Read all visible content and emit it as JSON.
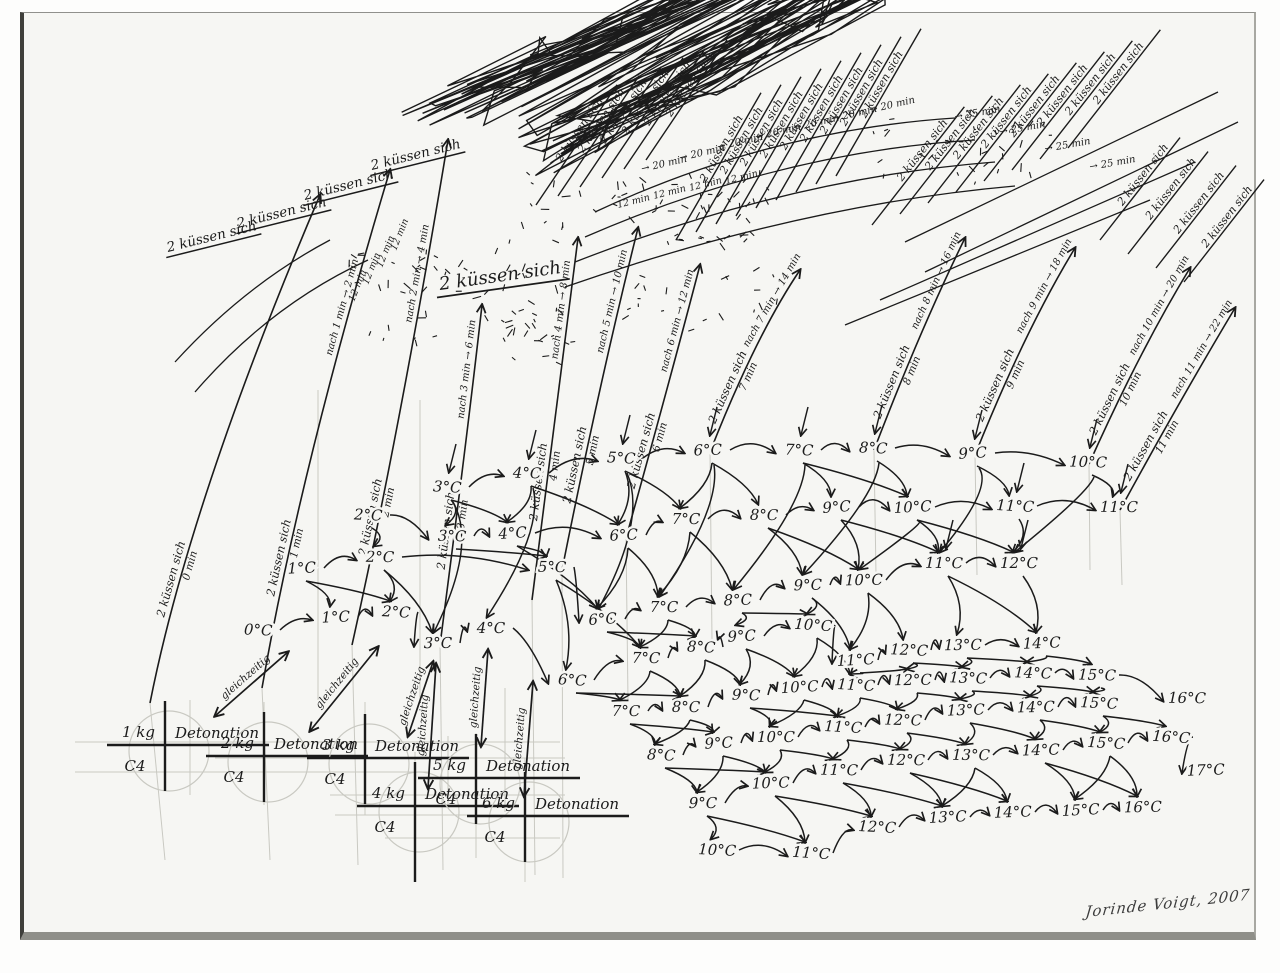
{
  "canvas": {
    "w": 1280,
    "h": 973,
    "paper": "#f6f6f3",
    "ink": "#1b1b1b",
    "pencil": "#c9c9c2",
    "signature": "Jorinde Voigt, 2007"
  },
  "labels": {
    "kiss": "2 küssen sich",
    "simultaneous": "gleichzeitig",
    "detonation_word": "Detonation",
    "c4_word": "C4"
  },
  "detonations": [
    {
      "kg": "1 kg",
      "x": 165,
      "y": 745
    },
    {
      "kg": "2 kg",
      "x": 264,
      "y": 756
    },
    {
      "kg": "3 kg",
      "x": 365,
      "y": 758
    },
    {
      "kg": "4 kg",
      "x": 415,
      "y": 806
    },
    {
      "kg": "5 kg",
      "x": 476,
      "y": 778
    },
    {
      "kg": "6 kg",
      "x": 525,
      "y": 816
    }
  ],
  "bands": [
    [
      [
        "3°C",
        447,
        492
      ],
      [
        "4°C",
        527,
        478
      ],
      [
        "5°C",
        621,
        463
      ],
      [
        "6°C",
        708,
        455
      ],
      [
        "7°C",
        799,
        455
      ],
      [
        "8°C",
        873,
        453
      ],
      [
        "9°C",
        973,
        458
      ],
      [
        "10°C",
        1088,
        467
      ]
    ],
    [
      [
        "2°C",
        368,
        520
      ],
      [
        "3°C",
        452,
        541
      ],
      [
        "4°C",
        513,
        538
      ],
      [
        "6°C",
        624,
        540
      ],
      [
        "7°C",
        686,
        524
      ],
      [
        "8°C",
        764,
        520
      ],
      [
        "9°C",
        837,
        512
      ],
      [
        "10°C",
        913,
        512
      ],
      [
        "11°C",
        1015,
        511
      ],
      [
        "11°C",
        1119,
        512
      ]
    ],
    [
      [
        "1°C",
        302,
        573
      ],
      [
        "2°C",
        380,
        562
      ],
      [
        "5°C",
        552,
        572
      ],
      [
        "6°C",
        603,
        624
      ],
      [
        "7°C",
        664,
        612
      ],
      [
        "8°C",
        738,
        605
      ],
      [
        "9°C",
        808,
        590
      ],
      [
        "10°C",
        864,
        585
      ],
      [
        "11°C",
        944,
        568
      ],
      [
        "12°C",
        1019,
        568
      ]
    ],
    [
      [
        "0°C",
        258,
        635
      ],
      [
        "1°C",
        336,
        622
      ],
      [
        "2°C",
        396,
        617
      ],
      [
        "3°C",
        438,
        648
      ],
      [
        "4°C",
        491,
        633
      ],
      [
        "6°C",
        572,
        685
      ],
      [
        "7°C",
        646,
        663
      ],
      [
        "8°C",
        701,
        652
      ],
      [
        "9°C",
        742,
        641
      ],
      [
        "10°C",
        813,
        630
      ],
      [
        "11°C",
        856,
        665
      ],
      [
        "12°C",
        909,
        655
      ],
      [
        "13°C",
        963,
        650
      ],
      [
        "14°C",
        1042,
        648
      ]
    ],
    [
      [
        "7°C",
        626,
        716
      ],
      [
        "8°C",
        686,
        712
      ],
      [
        "9°C",
        746,
        700
      ],
      [
        "10°C",
        800,
        692
      ],
      [
        "11°C",
        856,
        690
      ],
      [
        "12°C",
        913,
        685
      ],
      [
        "13°C",
        968,
        683
      ],
      [
        "14°C",
        1033,
        678
      ],
      [
        "15°C",
        1097,
        680
      ],
      [
        "16°C",
        1187,
        703
      ]
    ],
    [
      [
        "8°C",
        661,
        760
      ],
      [
        "9°C",
        719,
        748
      ],
      [
        "10°C",
        776,
        742
      ],
      [
        "11°C",
        843,
        732
      ],
      [
        "12°C",
        903,
        725
      ],
      [
        "13°C",
        966,
        715
      ],
      [
        "14°C",
        1036,
        712
      ],
      [
        "15°C",
        1099,
        708
      ]
    ],
    [
      [
        "9°C",
        703,
        808
      ],
      [
        "10°C",
        771,
        788
      ],
      [
        "11°C",
        839,
        775
      ],
      [
        "12°C",
        906,
        765
      ],
      [
        "13°C",
        971,
        760
      ],
      [
        "14°C",
        1041,
        755
      ],
      [
        "15°C",
        1106,
        748
      ],
      [
        "16°C",
        1171,
        742
      ],
      [
        "17°C",
        1206,
        775
      ]
    ],
    [
      [
        "10°C",
        717,
        855
      ],
      [
        "11°C",
        811,
        858
      ],
      [
        "12°C",
        877,
        832
      ],
      [
        "13°C",
        948,
        822
      ],
      [
        "14°C",
        1013,
        817
      ],
      [
        "15°C",
        1081,
        815
      ],
      [
        "16°C",
        1143,
        812
      ]
    ]
  ],
  "kiss_arcs": [
    {
      "min": "0 min",
      "note": "",
      "bx": 150,
      "by": 703,
      "cx": 190,
      "cy": 500,
      "ex": 320,
      "ey": 195
    },
    {
      "min": "1 min",
      "note": "nach 1 min → 2 min",
      "bx": 262,
      "by": 688,
      "cx": 300,
      "cy": 470,
      "ex": 390,
      "ey": 170
    },
    {
      "min": "2 min",
      "note": "nach 2 min → 4 min",
      "bx": 352,
      "by": 645,
      "cx": 400,
      "cy": 430,
      "ex": 448,
      "ey": 140
    },
    {
      "min": "3 min",
      "note": "nach 3 min → 6 min",
      "bx": 440,
      "by": 645,
      "cx": 468,
      "cy": 430,
      "ex": 482,
      "ey": 305
    },
    {
      "min": "4 min",
      "note": "nach 4 min → 8 min",
      "bx": 532,
      "by": 600,
      "cx": 560,
      "cy": 380,
      "ex": 578,
      "ey": 238
    },
    {
      "min": "5 min",
      "note": "nach 5 min → 10 min",
      "bx": 562,
      "by": 570,
      "cx": 600,
      "cy": 380,
      "ex": 638,
      "ey": 228
    },
    {
      "min": "6 min",
      "note": "nach 6 min → 12 min",
      "bx": 626,
      "by": 538,
      "cx": 670,
      "cy": 380,
      "ex": 700,
      "ey": 265
    },
    {
      "min": "7 min",
      "note": "nach 7 min → 14 min",
      "bx": 710,
      "by": 452,
      "cx": 756,
      "cy": 335,
      "ex": 800,
      "ey": 270
    },
    {
      "min": "8 min",
      "note": "nach 8 min → 16 min",
      "bx": 874,
      "by": 450,
      "cx": 920,
      "cy": 330,
      "ex": 965,
      "ey": 238
    },
    {
      "min": "9 min",
      "note": "nach 9 min → 18 min",
      "bx": 975,
      "by": 455,
      "cx": 1025,
      "cy": 330,
      "ex": 1075,
      "ey": 248
    },
    {
      "min": "10 min",
      "note": "nach 10 min → 20 min",
      "bx": 1089,
      "by": 464,
      "cx": 1140,
      "cy": 350,
      "ex": 1190,
      "ey": 268
    },
    {
      "min": "11 min",
      "note": "nach 11 min → 22 min",
      "bx": 1120,
      "by": 510,
      "cx": 1180,
      "cy": 400,
      "ex": 1235,
      "ey": 308
    }
  ],
  "rays": {
    "left_underlined": [
      [
        168,
        252
      ],
      [
        238,
        228
      ],
      [
        305,
        200
      ],
      [
        372,
        170
      ]
    ],
    "left_angle": -14,
    "left_size": 13.5,
    "big": {
      "x": 440,
      "y": 290,
      "angle": -8,
      "size": 18
    },
    "fans": [
      {
        "angle": -56,
        "len": 145,
        "size": 11,
        "starts": [
          [
            536,
            205
          ],
          [
            558,
            196
          ],
          [
            580,
            187
          ],
          [
            602,
            178
          ],
          [
            624,
            169
          ],
          [
            646,
            160
          ]
        ]
      },
      {
        "angle": -60,
        "len": 170,
        "size": 11,
        "starts": [
          [
            676,
            240
          ],
          [
            696,
            232
          ],
          [
            716,
            224
          ],
          [
            736,
            216
          ],
          [
            756,
            208
          ],
          [
            776,
            200
          ],
          [
            796,
            192
          ],
          [
            816,
            184
          ],
          [
            836,
            176
          ]
        ]
      },
      {
        "angle": -52,
        "len": 150,
        "size": 11,
        "starts": [
          [
            872,
            225
          ],
          [
            900,
            214
          ],
          [
            928,
            203
          ],
          [
            956,
            192
          ],
          [
            984,
            181
          ],
          [
            1012,
            170
          ],
          [
            1040,
            159
          ],
          [
            1068,
            148
          ]
        ]
      },
      {
        "angle": -52,
        "len": 130,
        "size": 11,
        "starts": [
          [
            1100,
            240
          ],
          [
            1128,
            254
          ],
          [
            1156,
            268
          ],
          [
            1184,
            282
          ]
        ]
      }
    ]
  },
  "annotations": [
    {
      "text": "→ 20 min",
      "angle": -13,
      "size": 10,
      "pts": [
        [
          642,
          172
        ],
        [
          680,
          161
        ],
        [
          718,
          150
        ],
        [
          756,
          140
        ],
        [
          794,
          131
        ],
        [
          832,
          122
        ],
        [
          870,
          113
        ]
      ]
    },
    {
      "text": "→ 25 min",
      "angle": -10,
      "size": 10,
      "pts": [
        [
          955,
          120
        ],
        [
          1000,
          135
        ],
        [
          1045,
          152
        ],
        [
          1090,
          170
        ]
      ]
    },
    {
      "text": "12 min",
      "angle": -14,
      "size": 9.5,
      "pts": [
        [
          618,
          208
        ],
        [
          654,
          199
        ],
        [
          690,
          191
        ],
        [
          726,
          184
        ]
      ]
    },
    {
      "text": "12 min",
      "angle": -68,
      "size": 9.5,
      "pts": [
        [
          354,
          302
        ],
        [
          368,
          285
        ],
        [
          382,
          268
        ],
        [
          396,
          251
        ]
      ]
    }
  ],
  "geometry": {
    "long_strokes": [
      [
        905,
        242,
        1218,
        92
      ],
      [
        925,
        272,
        1238,
        122
      ],
      [
        880,
        300,
        1195,
        162
      ],
      [
        845,
        325,
        1150,
        200
      ]
    ],
    "long_arcs": [
      [
        595,
        212,
        770,
        130,
        955,
        118
      ],
      [
        585,
        237,
        780,
        152,
        975,
        140
      ],
      [
        575,
        262,
        790,
        178,
        995,
        162
      ],
      [
        565,
        287,
        800,
        205,
        1015,
        186
      ],
      [
        175,
        362,
        245,
        285,
        330,
        240
      ],
      [
        195,
        392,
        270,
        305,
        368,
        260
      ]
    ],
    "sync_arrows": [
      [
        215,
        716,
        288,
        652
      ],
      [
        310,
        731,
        378,
        647
      ],
      [
        408,
        736,
        433,
        662
      ],
      [
        428,
        788,
        436,
        664
      ],
      [
        481,
        746,
        488,
        650
      ],
      [
        524,
        796,
        533,
        682
      ]
    ],
    "extra_links": [
      [
        708,
        455,
        664,
        612
      ],
      [
        799,
        455,
        738,
        605
      ],
      [
        873,
        453,
        808,
        590
      ],
      [
        973,
        458,
        944,
        568
      ],
      [
        621,
        463,
        603,
        624
      ],
      [
        527,
        478,
        491,
        633
      ],
      [
        447,
        492,
        438,
        648
      ],
      [
        1088,
        467,
        1019,
        568
      ],
      [
        913,
        512,
        864,
        585
      ]
    ],
    "chevrons": [
      [
        447,
        492
      ],
      [
        527,
        478
      ],
      [
        621,
        463
      ],
      [
        708,
        455
      ],
      [
        799,
        455
      ],
      [
        873,
        453
      ],
      [
        973,
        458
      ],
      [
        1088,
        467
      ],
      [
        1015,
        511
      ],
      [
        1119,
        512
      ],
      [
        944,
        568
      ],
      [
        1019,
        568
      ]
    ],
    "pencil": {
      "horizontals": [
        [
          742,
          75,
          560
        ],
        [
          758,
          215,
          565
        ],
        [
          772,
          75,
          430
        ],
        [
          795,
          330,
          565
        ],
        [
          815,
          335,
          565
        ],
        [
          838,
          385,
          560
        ]
      ],
      "verticals": [
        [
          190,
          700,
          795
        ],
        [
          264,
          702,
          805
        ],
        [
          365,
          702,
          815
        ],
        [
          415,
          752,
          880
        ],
        [
          476,
          733,
          858
        ],
        [
          525,
          758,
          882
        ],
        [
          448,
          736,
          805
        ],
        [
          505,
          688,
          812
        ],
        [
          318,
          390,
          700
        ],
        [
          420,
          400,
          700
        ]
      ],
      "arc_tails": [
        [
          150,
          703,
          165,
          860
        ],
        [
          262,
          688,
          270,
          860
        ],
        [
          352,
          645,
          358,
          865
        ],
        [
          440,
          645,
          443,
          870
        ],
        [
          532,
          600,
          535,
          875
        ],
        [
          562,
          570,
          563,
          878
        ],
        [
          626,
          538,
          628,
          700
        ],
        [
          710,
          452,
          712,
          640
        ],
        [
          874,
          450,
          876,
          575
        ],
        [
          975,
          455,
          977,
          575
        ],
        [
          1089,
          464,
          1090,
          570
        ],
        [
          1120,
          510,
          1122,
          585
        ]
      ]
    },
    "scatters": [
      [
        640,
        210,
        260,
        70,
        64
      ],
      [
        480,
        300,
        120,
        95,
        26
      ],
      [
        392,
        300,
        92,
        100,
        24
      ],
      [
        960,
        150,
        190,
        70,
        28
      ],
      [
        545,
        330,
        70,
        80,
        16
      ],
      [
        700,
        300,
        160,
        60,
        20
      ]
    ],
    "blobs": [
      [
        590,
        205,
        38,
        22,
        -25,
        44
      ],
      [
        663,
        218,
        26,
        16,
        -25,
        30
      ],
      [
        738,
        237,
        52,
        30,
        -28,
        84
      ],
      [
        614,
        188,
        30,
        14,
        -25,
        26
      ],
      [
        705,
        225,
        30,
        18,
        -28,
        30
      ]
    ]
  }
}
